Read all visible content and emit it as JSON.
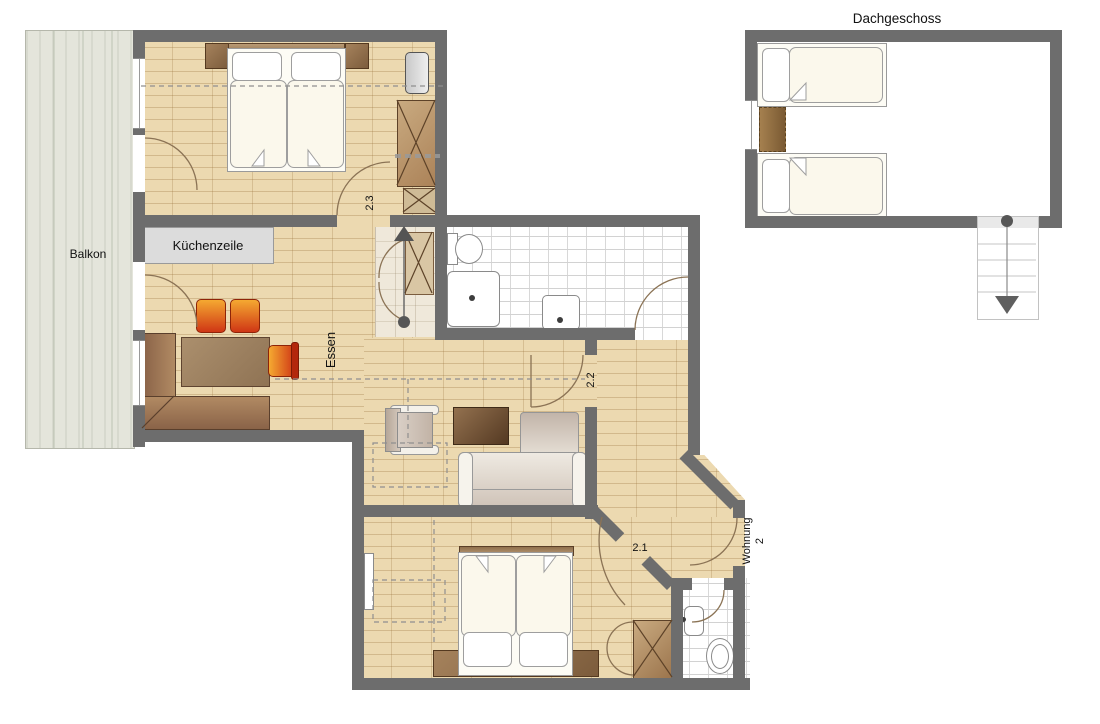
{
  "plan": {
    "attic": {
      "title": "Dachgeschoss"
    },
    "labels": {
      "balcony": "Balkon",
      "kitchen_unit": "Küchenzeile",
      "dining": "Essen",
      "bedroom_top": "2.3",
      "hallway": "2.2",
      "bedroom_bottom": "2.1",
      "apartment_name": "Wohnung",
      "apartment_number": "2"
    },
    "colors": {
      "wall": "#6d6d6d",
      "parquet": "#ecd9b0",
      "parquet_joint": "#c9ad80",
      "balcony_floor": "#e4e5db",
      "tile_grout": "#d2d2d2",
      "furniture_wood": "#96734e",
      "bench_wood": "#7c5a44",
      "accent_orange": "#e2601c",
      "accent_orange_light": "#f5a623",
      "linen": "#fbf8ec",
      "fixture_gray": "#d9d9d9"
    }
  }
}
